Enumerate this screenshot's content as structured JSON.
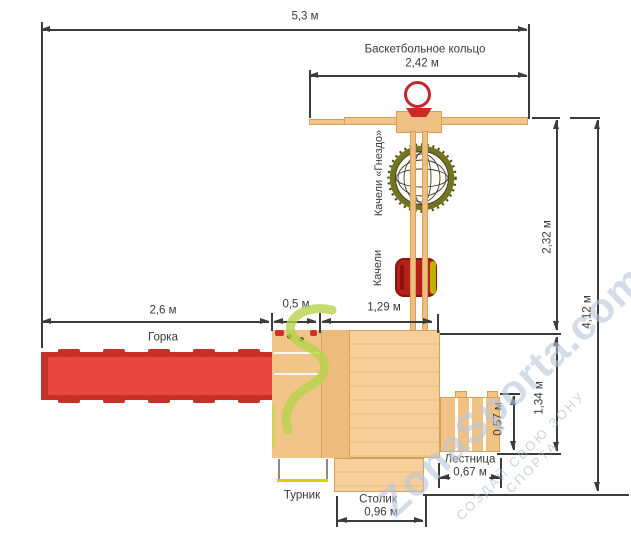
{
  "diagram": {
    "labels": {
      "basketball_hoop": "Баскетбольное кольцо",
      "nest_swing": "Качели «Гнездо»",
      "swing": "Качели",
      "slide": "Горка",
      "ladder": "Лестница",
      "pull_up_bar": "Турник",
      "table": "Столик"
    },
    "dims": {
      "total_width": "5,3 м",
      "hoop_beam_width": "2,42 м",
      "beam_to_platform_height": "2,32 м",
      "total_height": "4,12 м",
      "slide_length": "2,6 м",
      "small_platform_width": "0,5 м",
      "platform_width": "1,29 м",
      "platform_to_bottom": "1,34 м",
      "ladder_depth": "0,57 м",
      "ladder_width": "0,67 м",
      "table_width": "0,96 м"
    },
    "watermark": {
      "brand": "ZonaSporta.com",
      "slogan": "СОЗДАЙ СВОЮ ЗОНУ СПОРТА"
    },
    "colors": {
      "wood": "#f2c48a",
      "wood_border": "#d5a159",
      "slide_red": "#e8453f",
      "slide_rail_red": "#c43129",
      "seat_red": "#b71f1b",
      "hoop_red": "#c1272d",
      "nest_ring_olive": "#74731e",
      "pullup_bar_yellow": "#d6d400",
      "watermark_blue": "#b9c6da",
      "watermark_green": "#b7d44d",
      "dimension_line": "#3c3c3c"
    }
  }
}
